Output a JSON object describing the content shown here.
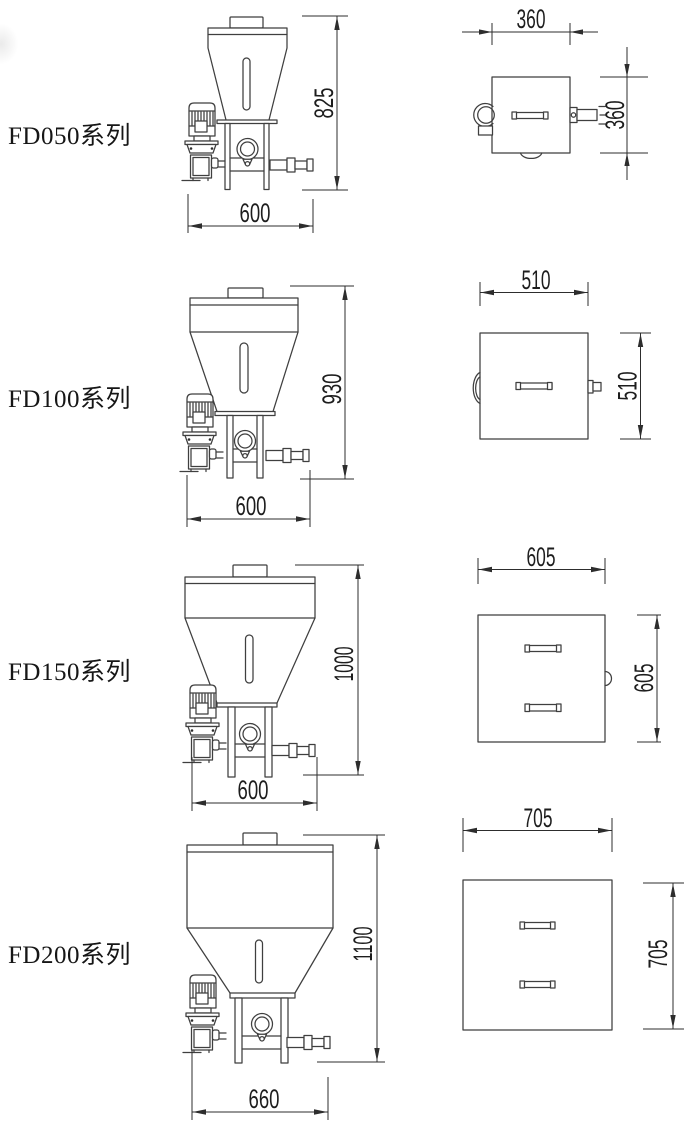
{
  "page": {
    "background": "#ffffff",
    "line_color": "#3f3f3f",
    "dimension_color": "#2d2d2d",
    "text_color": "#161616"
  },
  "rows": [
    {
      "id": "FD050",
      "label": "FD050系列",
      "front": {
        "height": "825",
        "width": "600"
      },
      "top": {
        "width": "360",
        "depth": "360"
      }
    },
    {
      "id": "FD100",
      "label": "FD100系列",
      "front": {
        "height": "930",
        "width": "600"
      },
      "top": {
        "width": "510",
        "depth": "510"
      }
    },
    {
      "id": "FD150",
      "label": "FD150系列",
      "front": {
        "height": "1000",
        "width": "600"
      },
      "top": {
        "width": "605",
        "depth": "605"
      }
    },
    {
      "id": "FD200",
      "label": "FD200系列",
      "front": {
        "height": "1100",
        "width": "660"
      },
      "top": {
        "width": "705",
        "depth": "705"
      }
    }
  ]
}
